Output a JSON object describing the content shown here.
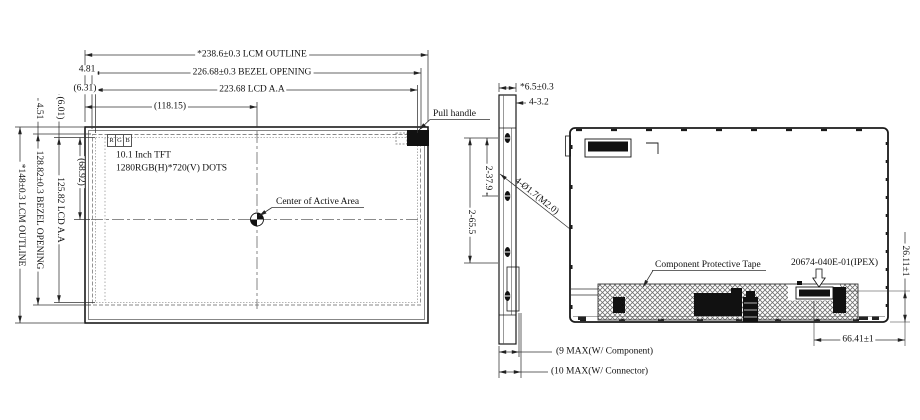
{
  "colors": {
    "line": "#1a1a1a",
    "dim": "#333333",
    "fill": "#111111",
    "hatch": "#707070"
  },
  "front": {
    "dim_lcm_width": "*238.6±0.3 LCM OUTLINE",
    "dim_bezel_width": "226.68±0.3 BEZEL OPENING",
    "dim_aa_width": "223.68 LCD A.A",
    "dim_center_x": "(118.15)",
    "dim_offset_bezel_left": "4.81",
    "dim_offset_aa_left": "(6.31)",
    "dim_offset_bezel_top": "4.51",
    "dim_offset_aa_top": "(6.01)",
    "dim_center_y": "(68.92)",
    "dim_aa_height": "125.82 LCD A.A",
    "dim_bezel_height": "128.82±0.3 BEZEL OPENING",
    "dim_lcm_height": "*148±0.3 LCM OUTLINE",
    "rgb_marker": [
      "R",
      "G",
      "B"
    ],
    "panel_type": "10.1 Inch TFT",
    "panel_resolution": "1280RGB(H)*720(V) DOTS",
    "center_label": "Center of Active Area",
    "pull_handle_label": "Pull handle"
  },
  "side": {
    "dim_thickness": "*6.5±0.3",
    "dim_boss": "4-3.2",
    "dim_hole_span_1": "2-37.9",
    "dim_hole_span_2": "2-65.5",
    "dim_hole_size": "4-Ø1.7(M2.0)",
    "dim_max_component": "(9 MAX(W/ Component)",
    "dim_max_connector": "(10 MAX(W/ Connector)"
  },
  "back": {
    "tape_label": "Component Protective Tape",
    "connector_part": "20674-040E-01(IPEX)",
    "dim_connector_vertical": "26.11±1",
    "dim_connector_horizontal": "66.41±1"
  }
}
